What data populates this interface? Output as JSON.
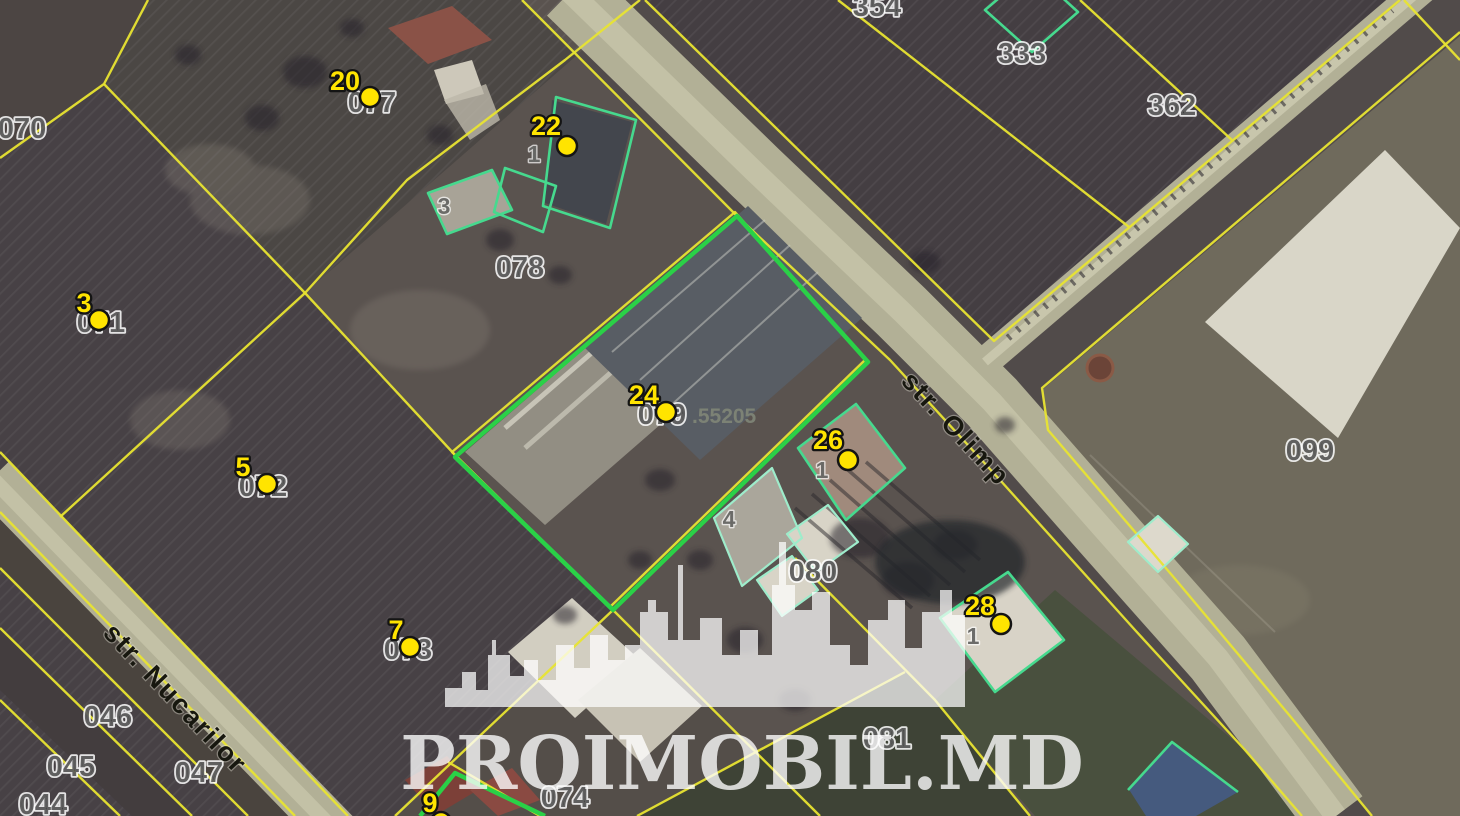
{
  "map": {
    "watermark": {
      "text": "PROIMOBIL.MD"
    },
    "streets": [
      {
        "name": "str. Olimp"
      },
      {
        "name": "str. Nucarilor"
      }
    ],
    "markers": [
      {
        "number": "20",
        "parcel": "077"
      },
      {
        "number": "22",
        "building": "1"
      },
      {
        "number": "24",
        "parcel": "079",
        "suffix": ".55205"
      },
      {
        "number": "26",
        "building": "1"
      },
      {
        "number": "28",
        "building": "1"
      },
      {
        "number": "3",
        "parcel": "071"
      },
      {
        "number": "5",
        "parcel": "072"
      },
      {
        "number": "7",
        "parcel": "073"
      },
      {
        "number": "9"
      }
    ],
    "parcel_labels": [
      "070",
      "354",
      "333",
      "362",
      "078",
      "099",
      "080",
      "081",
      "074",
      "047",
      "046",
      "045",
      "044"
    ],
    "outbuilding_labels": [
      "3",
      "4"
    ],
    "colors": {
      "boundary_yellow": "#e8e431",
      "highlight_green": "#2ad147",
      "building_green": "#46d98e",
      "marker_yellow": "#ffe400",
      "road": "#b2b096"
    }
  }
}
